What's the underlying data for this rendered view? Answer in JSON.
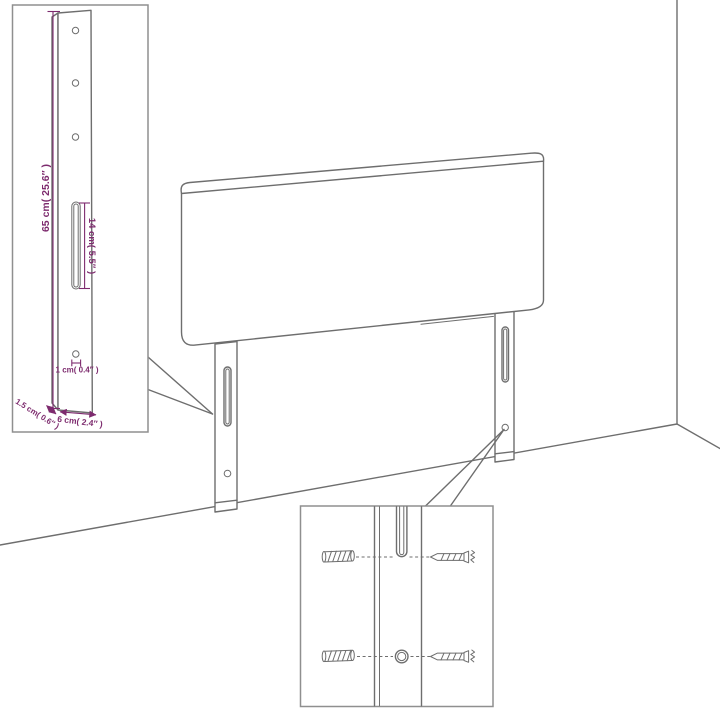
{
  "diagram": {
    "subject": "headboard wall-mounting assembly diagram"
  },
  "colors": {
    "outline": "#6e6e6e",
    "inset_border": "#8f8f8f",
    "dimension": "#7d2b6e",
    "background": "#ffffff"
  },
  "leg_detail": {
    "height_label": "65 cm( 25.6″ )",
    "slot_label": "14 cm( 5.5″ )",
    "hole_label": "1 cm( 0.4″ )",
    "depth_label": "1.5 cm( 0.6″ )",
    "width_label": "6 cm( 2.4″ )"
  },
  "icons": {
    "wall_plug": "wall-plug-icon",
    "screw": "screw-icon"
  }
}
